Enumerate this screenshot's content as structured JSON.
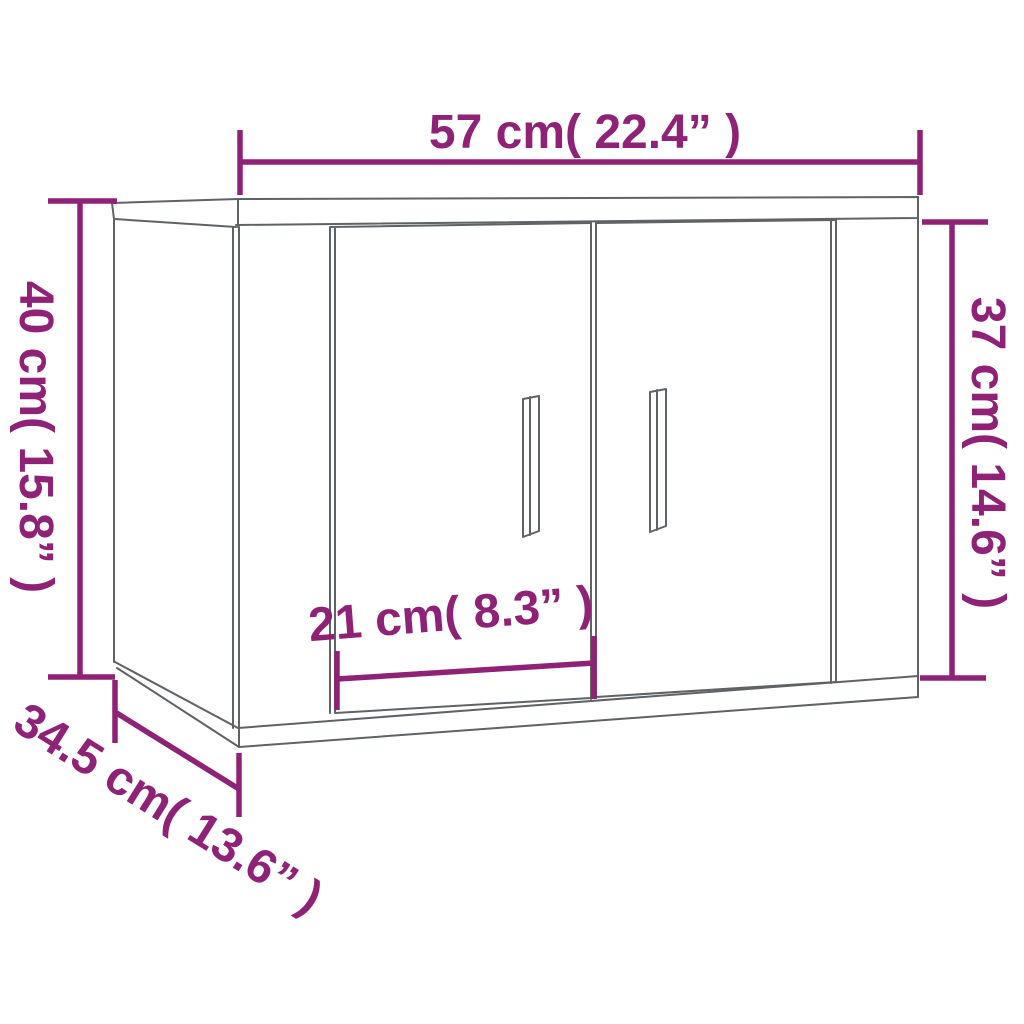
{
  "diagram": {
    "kind": "product-dimension-diagram",
    "subject": "wall-mounted cabinet with two doors",
    "colors": {
      "dimension_accent": "#8F2277",
      "cabinet_outline": "#5F6366",
      "background": "#FFFFFF"
    },
    "dimensions": {
      "top_width": {
        "label": "57 cm( 22.4” )",
        "cm": 57,
        "inches": 22.4
      },
      "left_height": {
        "label": "40 cm( 15.8” )",
        "cm": 40,
        "inches": 15.8
      },
      "right_height": {
        "label": "37 cm( 14.6” )",
        "cm": 37,
        "inches": 14.6
      },
      "door_width": {
        "label": "21 cm( 8.3” )",
        "cm": 21,
        "inches": 8.3
      },
      "depth": {
        "label": "34.5 cm( 13.6” )",
        "cm": 34.5,
        "inches": 13.6
      }
    }
  }
}
